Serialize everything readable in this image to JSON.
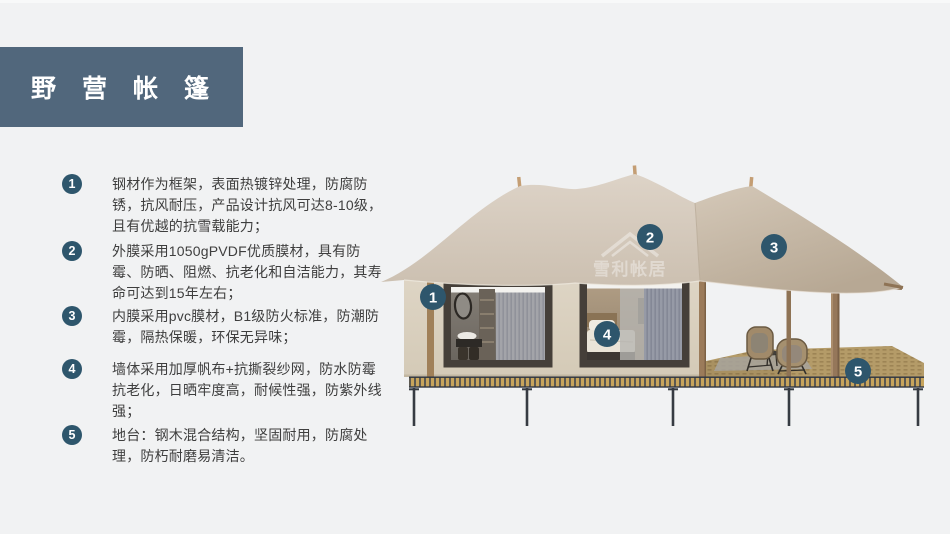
{
  "title": {
    "text": "野营帐篷",
    "bg": "#51677c",
    "color": "#ffffff"
  },
  "features": [
    {
      "num": "1",
      "text": "钢材作为框架，表面热镀锌处理，防腐防锈，抗风耐压，产品设计抗风可达8-10级，且有优越的抗雪载能力；"
    },
    {
      "num": "2",
      "text": "外膜采用1050gPVDF优质膜材，具有防霉、防晒、阻燃、抗老化和自洁能力，其寿命可达到15年左右；"
    },
    {
      "num": "3",
      "text": "内膜采用pvc膜材，B1级防火标准，防潮防霉，隔热保暖，环保无异味；"
    },
    {
      "num": "4",
      "text": "墙体采用加厚帆布+抗撕裂纱网，防水防霉抗老化，日晒牢度高，耐候性强，防紫外线强；"
    },
    {
      "num": "5",
      "text": "地台：钢木混合结构，坚固耐用，防腐处理，防朽耐磨易清洁。"
    }
  ],
  "diagram": {
    "watermark": {
      "text": "雪利帐居"
    },
    "callouts": [
      {
        "num": "1",
        "x": 433,
        "y": 297
      },
      {
        "num": "2",
        "x": 650,
        "y": 237
      },
      {
        "num": "3",
        "x": 774,
        "y": 247
      },
      {
        "num": "4",
        "x": 607,
        "y": 334
      },
      {
        "num": "5",
        "x": 858,
        "y": 371
      }
    ],
    "colors": {
      "callout": "#2e566c",
      "badge": "#2e566c",
      "canopy_light": "#dcd2c6",
      "canopy_dark": "#b7a894",
      "wall": "#dcd3c3",
      "deck_gold": "#c7a45c",
      "deck_dark": "#41464e",
      "wood": "#95775a",
      "steel": "#363b42"
    }
  }
}
